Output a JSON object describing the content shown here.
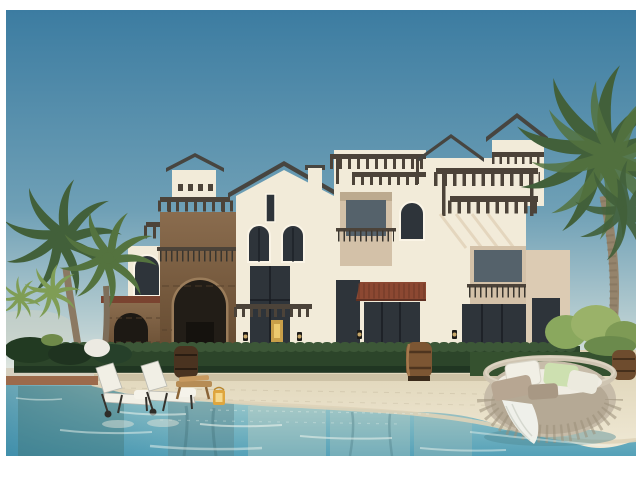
{
  "scene": {
    "alt": "Sunny architectural rendering of a white Mediterranean-style villa complex with wooden pergolas, arched windows, a rustic stone tower, palm trees, a hedge row with wooden barrels, two white sun loungers, a lantern, a round wicker daybed with pillows and a turquoise swim-up pool with a sandy beach edge in the foreground.",
    "elements": {
      "sky": "clear blue sky",
      "building": "white villa block with pergolas and arched windows",
      "stone_tower": "stone-clad tower with large arch",
      "cupola": "small roof cupola with tiled cap",
      "hedge": "trimmed green hedge row",
      "palms_left": "tall palm trees on the left",
      "palm_right": "large palm tree on the right",
      "pool": "turquoise pool water with reflections",
      "beach": "sandy beach-entry deck",
      "loungers": "two white sun loungers",
      "daybed": "round wicker daybed with cushions",
      "barrels": "decorative wooden barrels",
      "lantern": "yellow candle lantern"
    }
  },
  "colors": {
    "frame": "#ffffff",
    "sky_top": "#3c7ca1",
    "sky_mid": "#6fa0b6",
    "sky_low": "#bdd1d3",
    "sky_horizon": "#e6e9e1",
    "wall_light": "#f2ebd9",
    "wall_shade": "#dccbb3",
    "roof_tile": "#474540",
    "wood_dark": "#4c4339",
    "stone_light": "#8a6c4e",
    "stone_dark": "#63492f",
    "glass_dark": "#2e343a",
    "awning_red": "#8c4832",
    "hedge": "#2c452a",
    "palm_dark": "#42603a",
    "palm_bright": "#7f9d55",
    "trunk": "#8b7962",
    "sand": "#e4dabf",
    "sand_light": "#efe8d4",
    "paver_red": "#9c6a4b",
    "water_edge": "#b7d6d0",
    "water_mid": "#8cc0c7",
    "water_deep": "#55a1b8",
    "wicker": "#c7bca9",
    "cushion_white": "#f1efe5",
    "cushion_beige": "#b7a692",
    "cushion_green": "#cde0b0",
    "barrel_brown": "#7c5633",
    "lantern_yellow": "#dfa63e"
  }
}
